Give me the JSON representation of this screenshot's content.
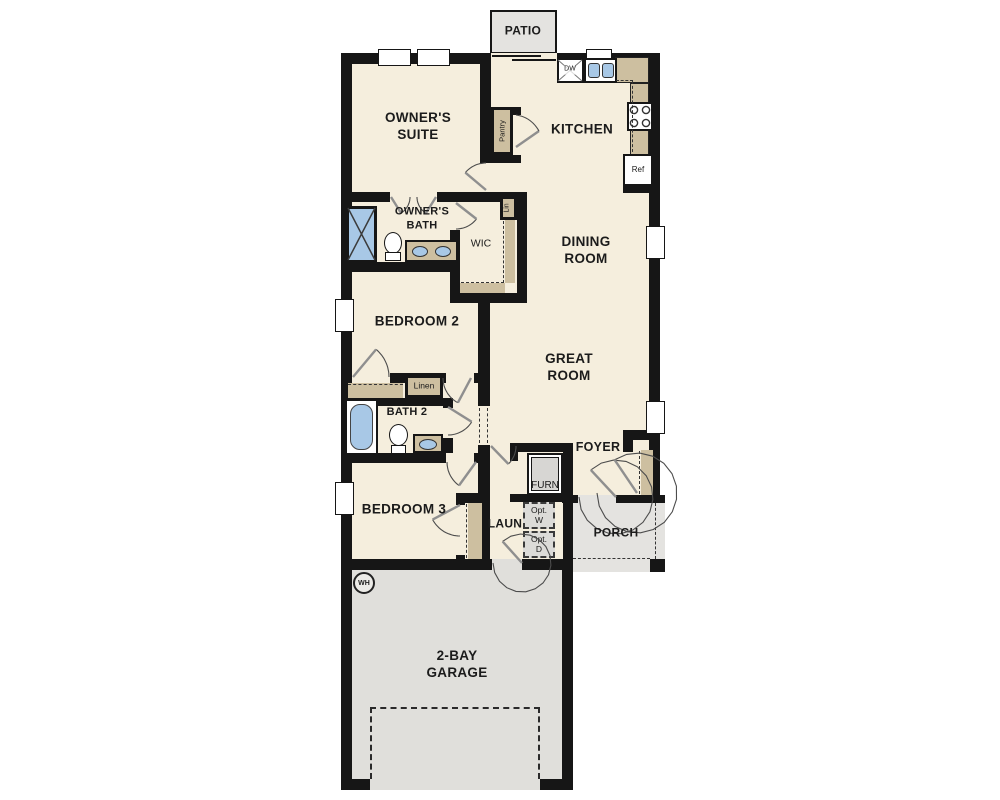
{
  "plan": {
    "rooms": {
      "patio": "PATIO",
      "owners_suite": "OWNER'S SUITE",
      "kitchen": "KITCHEN",
      "dining_room": "DINING ROOM",
      "owners_bath": "OWNER'S BATH",
      "wic": "WIC",
      "bedroom2": "BEDROOM 2",
      "great_room": "GREAT ROOM",
      "bath2": "BATH 2",
      "bedroom3": "BEDROOM 3",
      "laundry": "LAUN",
      "foyer": "FOYER",
      "porch": "PORCH",
      "garage": "2-BAY GARAGE"
    },
    "closets": {
      "pantry": "Pantry",
      "lin": "Lin",
      "linen": "Linen"
    },
    "fixtures": {
      "dishwasher": "DW",
      "refrigerator": "Ref",
      "furnace": "FURN",
      "opt_washer": "Opt. W",
      "opt_dryer": "Opt. D",
      "water_heater": "WH"
    },
    "colors": {
      "floor": "#f5eedd",
      "wall": "#161616",
      "cabinet_tan": "#cdbfa0",
      "concrete_gray": "#e4e3e0",
      "fixture_blue": "#a8c8e6"
    }
  }
}
